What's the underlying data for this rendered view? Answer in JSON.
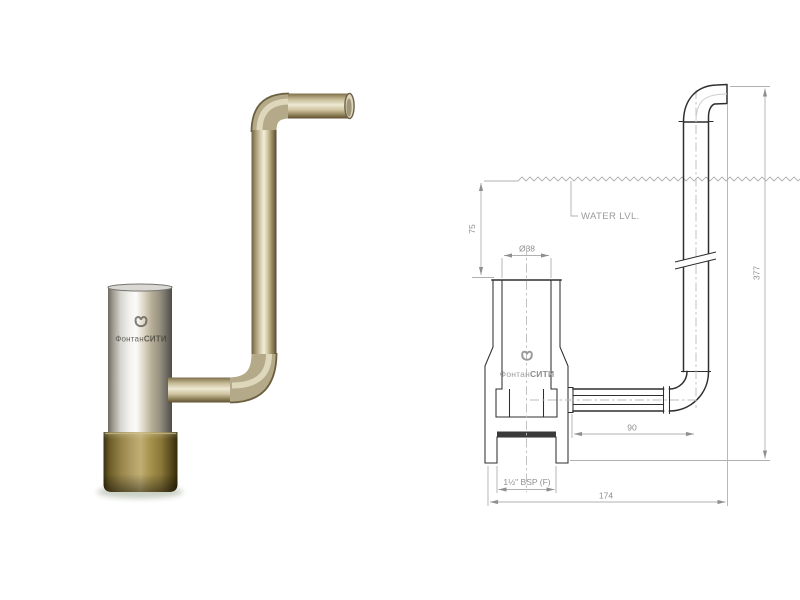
{
  "brand": {
    "icon": "fountain-city-monogram-icon",
    "text_regular": "Фонтан",
    "text_bold": "СИТИ"
  },
  "photo": {
    "logo": {
      "text_regular": "Фонтан",
      "text_bold": "СИТИ"
    }
  },
  "drawing": {
    "water_level_label": "WATER LVL.",
    "logo": {
      "text_regular": "Фонтан",
      "text_bold": "СИТИ"
    },
    "dimensions": {
      "water_depth_mm": "75",
      "inlet_diameter": "Ø38",
      "overall_height_mm": "377",
      "pipe_offset_mm": "90",
      "overall_width_mm": "174",
      "thread_spec": "1½\" BSP (F)"
    }
  },
  "colors": {
    "brass": "#a8954f",
    "chrome_highlight": "#f3f2ef",
    "pipe_metal": "#d7ceaf",
    "object_line": "#2f2f2f",
    "dimension_line": "#b0b0b0",
    "dimension_text": "#8f8f8f"
  }
}
